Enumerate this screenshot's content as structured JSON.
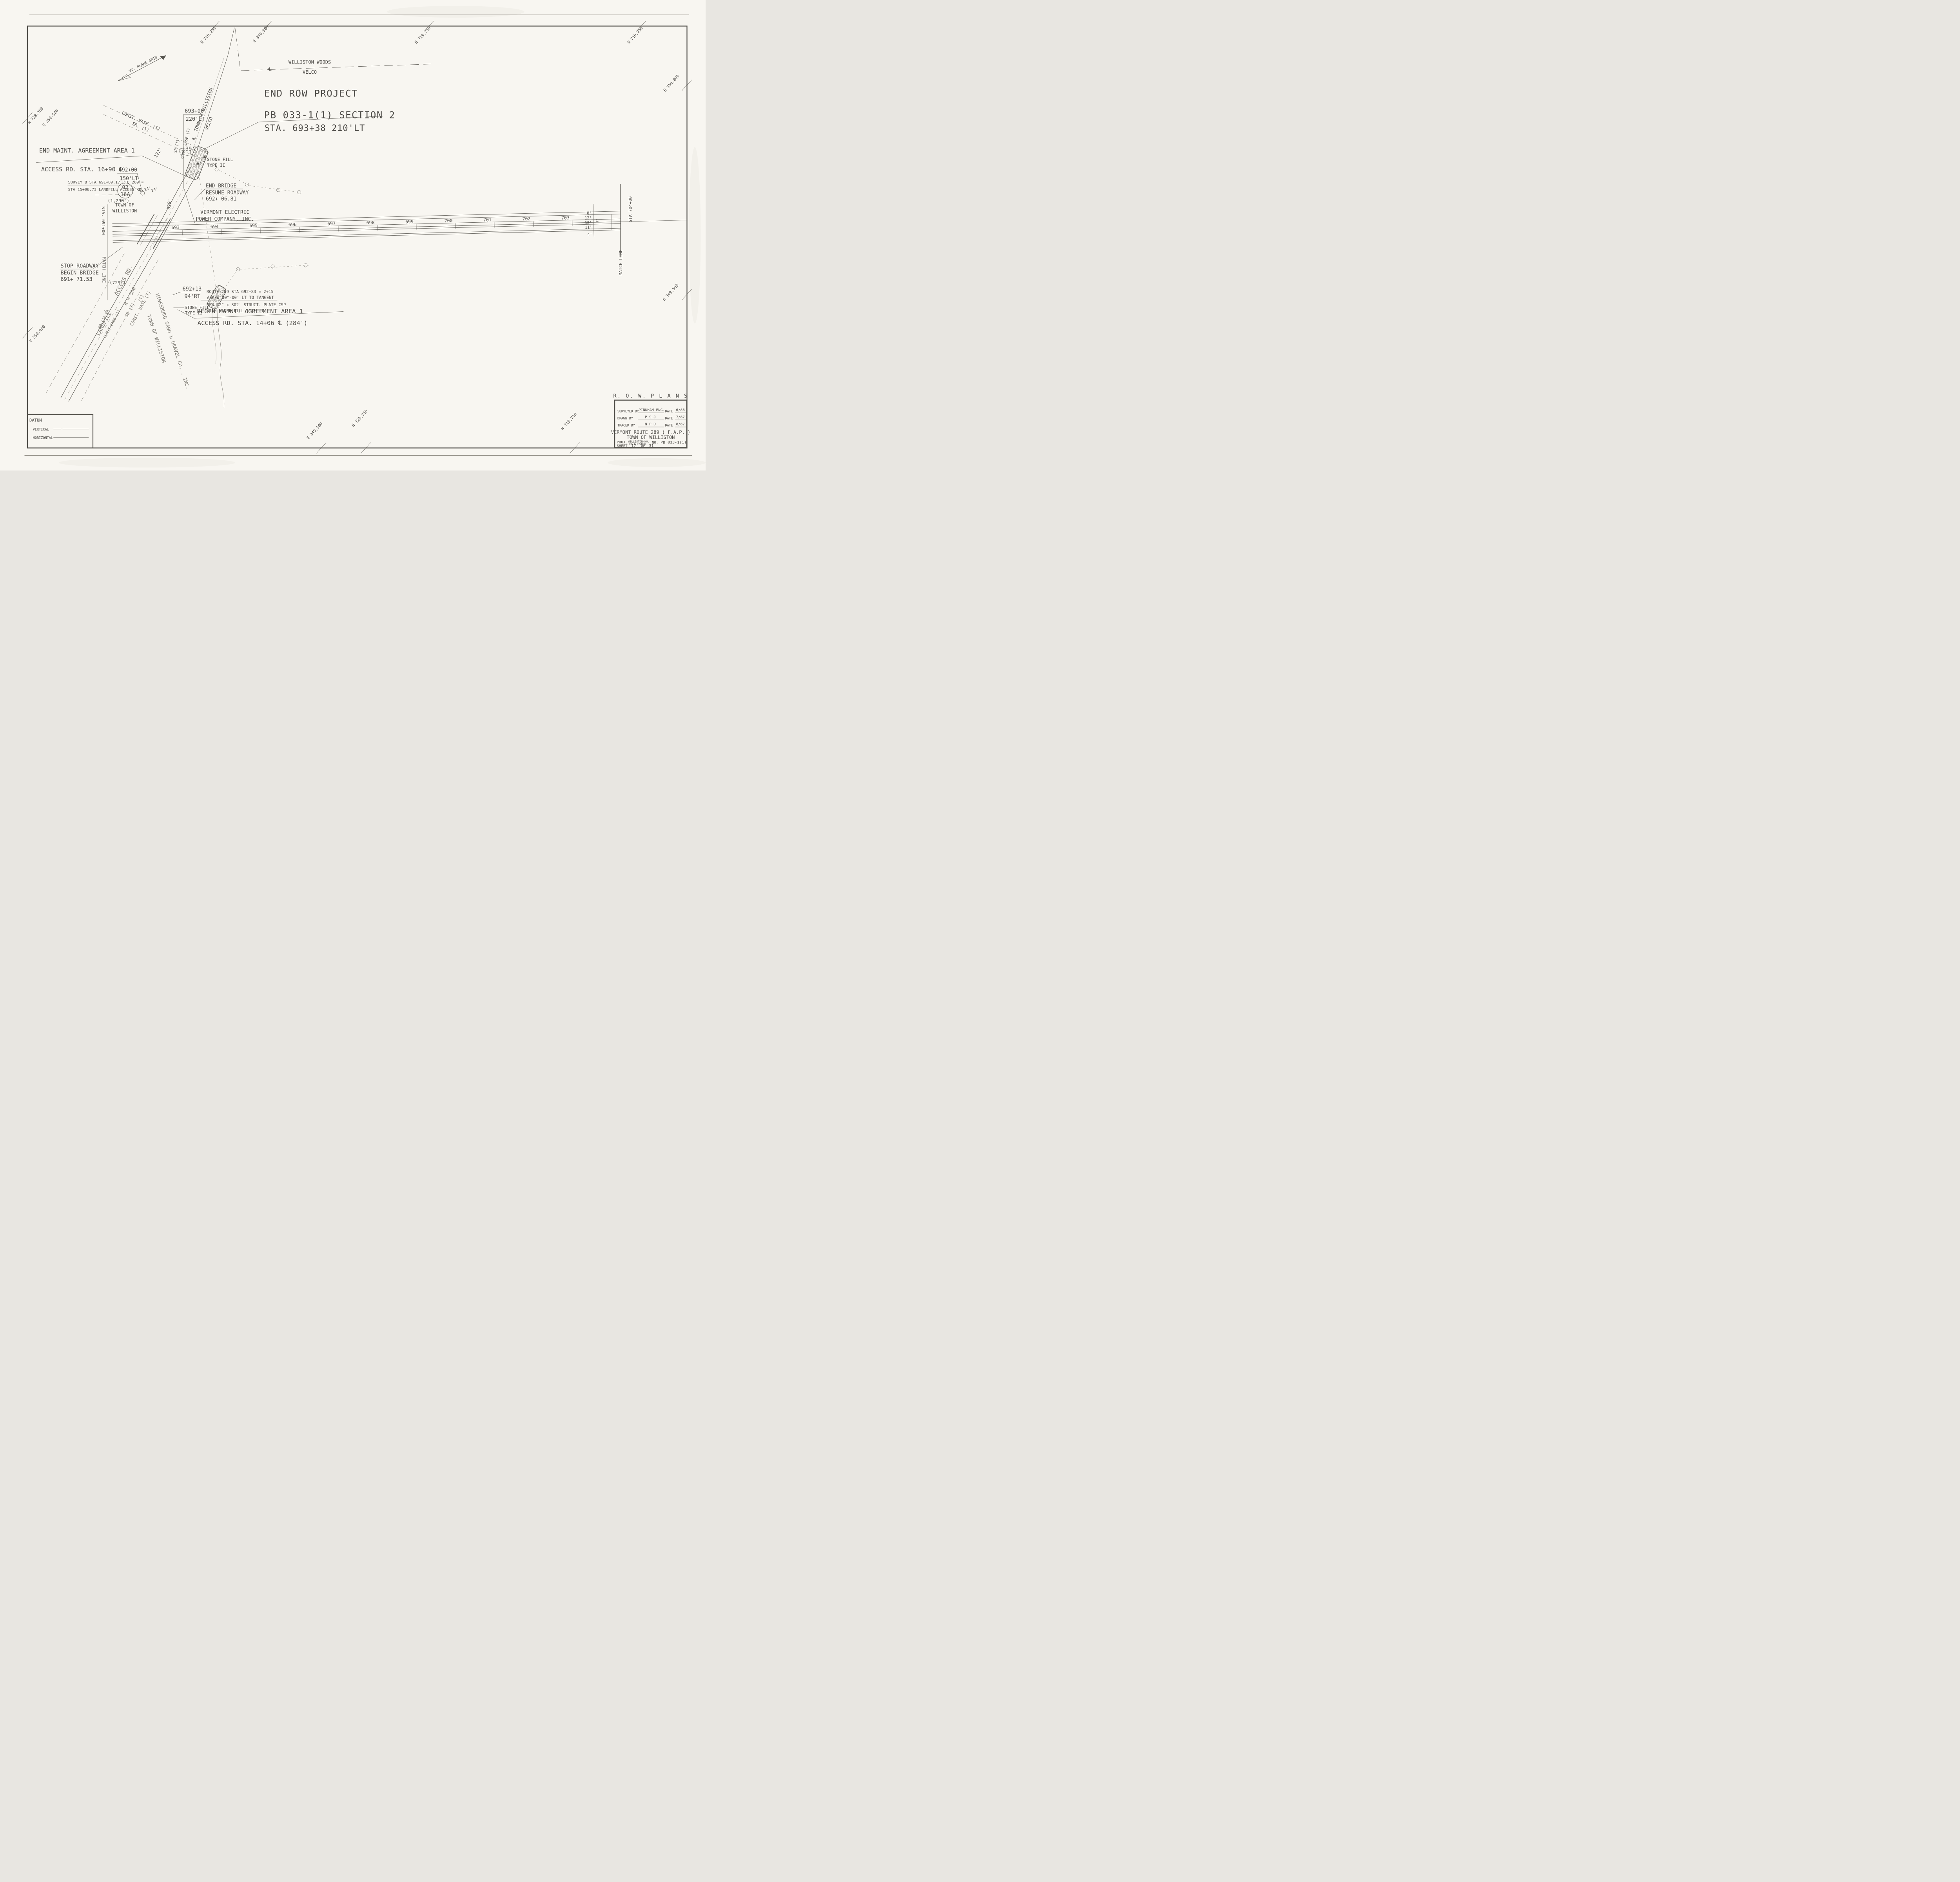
{
  "title": {
    "row_plans": "R. O. W.   P L A N S",
    "project_l1": "END ROW PROJECT",
    "project_l2": "PB 033-1(1)  SECTION 2",
    "project_sta": "STA. 693+38   210'LT"
  },
  "block": {
    "surveyed_label": "SURVEYED BY",
    "surveyed": "PINKHAM ENG.",
    "date_label1": "DATE",
    "surveyed_date": "6/86",
    "drawn_label": "DRAWN BY",
    "drawn": "P S J",
    "date_label2": "DATE",
    "drawn_date": "7/87",
    "traced_label": "TRACED BY",
    "traced": "N P D",
    "date_label3": "DATE",
    "traced_date": "8/87",
    "route": "VERMONT ROUTE 289 ( F.A.P. )",
    "town": "TOWN  OF  WILLISTON",
    "proj_label": "PROJ.",
    "proj_name1": "WILLISTON-NO.",
    "proj_name2": "COLCHESTER",
    "no_label": "NO.",
    "proj_no": "PB 033-1(1)",
    "sheet_label": "SHEET",
    "sheet_no": "17",
    "of_label": "OF",
    "sheet_total": "31"
  },
  "datum": {
    "title": "DATUM",
    "vertical": "VERTICAL",
    "horizontal": "HORIZONTAL"
  },
  "north": {
    "label": "VT. PLANE GRID"
  },
  "road": {
    "stations": [
      "693",
      "694",
      "695",
      "696",
      "697",
      "698",
      "699",
      "700",
      "701",
      "702",
      "703"
    ],
    "dims": [
      "8'",
      "12'",
      "12'",
      "11'",
      "4'"
    ],
    "cl": "℄"
  },
  "match_left": {
    "sta": "STA. 691+00",
    "label": "MATCH LINE",
    "dist": "(729')"
  },
  "match_right": {
    "sta": "STA 704+00",
    "label": "MATCH LINE"
  },
  "labels": {
    "woods1": "WILLISTON WOODS",
    "woods2": "VELCO",
    "endm1": "END MAINT. AGREEMENT AREA 1",
    "endm2": "ACCESS RD. STA. 16+90 ℄",
    "s693": "693+00",
    "s693o": "220'LT",
    "s692": "692+00",
    "s692o": "150'LT",
    "surv1": "SURVEY B STA 691+89.17 RTE 289 =",
    "surv2": "STA 15+06.73 LANDFILL ACCESS RD.",
    "d1290": "(1,290')",
    "c02": "02",
    "c16a": "16A",
    "town1": "TOWN OF",
    "town2": "WILLISTON",
    "stop1": "STOP ROADWAY",
    "stop2": "BEGIN BRIDGE",
    "stop3": "691+ 71.53",
    "endb1": "END BRIDGE",
    "endb2": "RESUME ROADWAY",
    "endb3": "692+ 06.81",
    "vep1": "VERMONT ELECTRIC",
    "vep2": "POWER COMPANY, INC.",
    "note1": "ROUTE 289  STA 692+83 = 2+15",
    "note2": "ASKEW 80°-00' LT TO TANGENT",
    "note3": "NEW 72\" x 302'  STRUCT. PLATE CSP",
    "note4": "WITH STONE FILL TYPE II",
    "s69213": "692+13",
    "s69213o": "94'RT",
    "stfn1": "STONE FILL",
    "stfn2": "TYPE II",
    "stfs1": "STONE FILL",
    "stfs2": "TYPE II",
    "beg1": "BEGIN MAINT. AGREEMENT AREA 1",
    "beg2": "ACCESS RD. STA. 14+06 ℄ (284')",
    "d39": "39'",
    "d122": "122'",
    "d329": "329'",
    "d14a": "14'",
    "d14b": "14'",
    "tline1": "TOWN OF WILLISTON",
    "tline2": "VELCO",
    "clsym": "℄",
    "clsym2": "℄",
    "hines": "HINESBURG SAND & GRAVEL CO. , INC.",
    "tdiag2": "TOWN OF WILLISTON",
    "landfill": "LANDFILL",
    "accessrd": "ACCESS RD.",
    "r500": "R = 500'",
    "t13": "13",
    "sr_top": "SR. (T)",
    "ce_top": "CONST. EASE. (T)",
    "sr_v": "SR (T)",
    "ce_v": "CONST EASE.(T)",
    "sr_e": "SR (T)",
    "ce_e": "CONST. EASE (T)",
    "tpar": "(T)",
    "sr_w": "SR (T)",
    "ce_w": "CONST EASE (T)"
  },
  "edge": [
    "N 720,250",
    "E 350,500",
    "N 719,750",
    "N 719,250",
    "E 350,000",
    "E 349,500",
    "N 719,750",
    "N 720,250",
    "E 349,500",
    "E 350,000",
    "N 720,750",
    "E 350,500"
  ]
}
